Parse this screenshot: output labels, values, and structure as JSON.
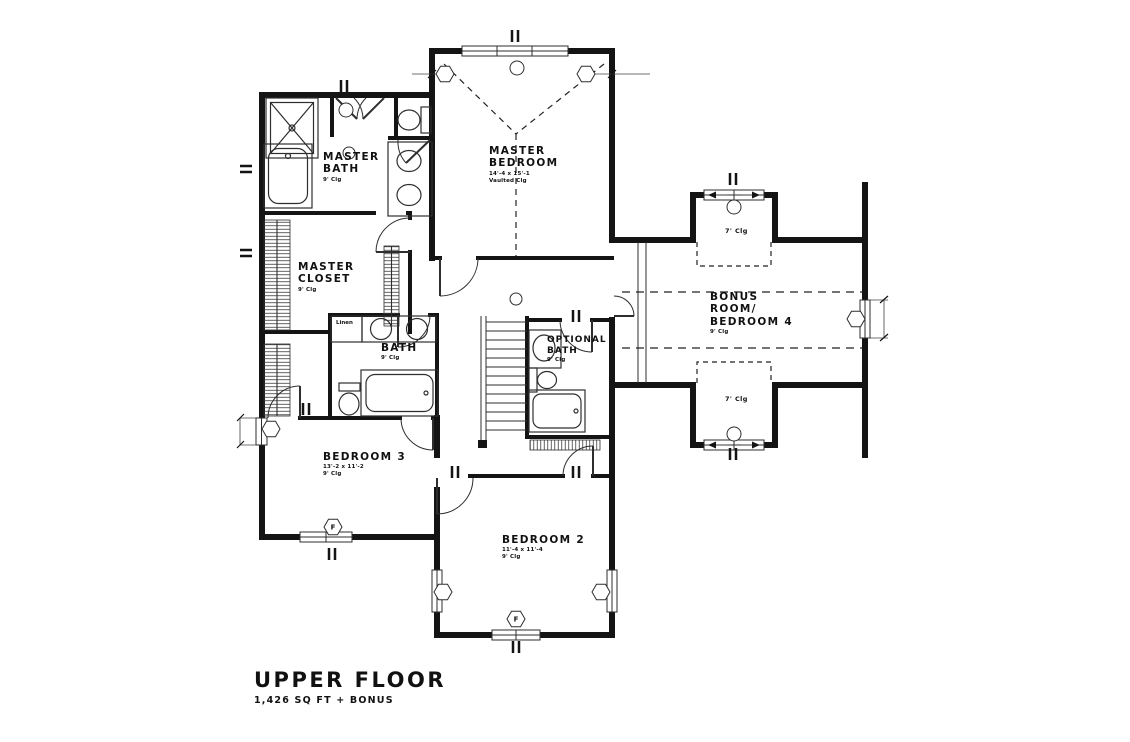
{
  "title": {
    "main": "UPPER FLOOR",
    "subtitle": "1,426 SQ FT + BONUS"
  },
  "rooms": {
    "master_bedroom": {
      "line1": "MASTER",
      "line2": "BEDROOM",
      "dims": "14'-4 x 15'-1",
      "ceiling": "Vaulted Clg"
    },
    "master_bath": {
      "line1": "MASTER",
      "line2": "BATH",
      "ceiling": "9' Clg"
    },
    "master_closet": {
      "line1": "MASTER",
      "line2": "CLOSET",
      "ceiling": "9' Clg"
    },
    "bath": {
      "line1": "BATH",
      "ceiling": "9' Clg"
    },
    "optional_bath": {
      "line1": "OPTIONAL",
      "line2": "BATH",
      "ceiling": "9' Clg"
    },
    "bonus_room": {
      "line1": "BONUS",
      "line2": "ROOM/",
      "line3": "BEDROOM 4",
      "ceiling": "9' Clg"
    },
    "bedroom3": {
      "line1": "BEDROOM 3",
      "dims": "13'-2 x 11'-2",
      "ceiling": "9' Clg"
    },
    "bedroom2": {
      "line1": "BEDROOM 2",
      "dims": "11'-4 x 11'-4",
      "ceiling": "9' Clg"
    },
    "linen": {
      "line1": "Linen"
    },
    "dormer_top": {
      "ceiling": "7' Clg"
    },
    "dormer_bottom": {
      "ceiling": "7' Clg"
    }
  },
  "markers": {
    "window_f_bedroom3": "F",
    "window_f_bedroom2": "F"
  },
  "colors": {
    "wall": "#141414",
    "line": "#2e2e2e",
    "hatch": "#3a3a3a"
  }
}
